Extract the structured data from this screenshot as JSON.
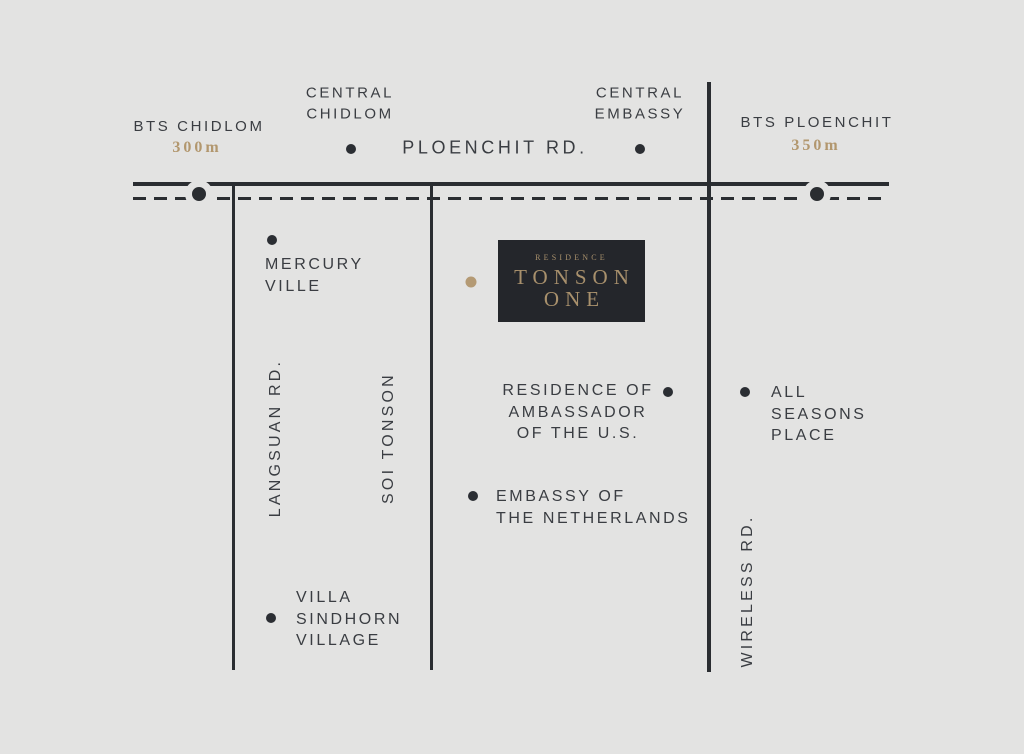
{
  "colors": {
    "background": "#e3e3e2",
    "ink": "#2a2d31",
    "text": "#3a3d42",
    "gold": "#b2976e",
    "logo_background": "#24262b",
    "logo_gold": "#a8906c"
  },
  "top": {
    "central_chidlom": "CENTRAL\nCHIDLOM",
    "central_embassy": "CENTRAL\nEMBASSY",
    "bts_chidlom": "BTS CHIDLOM",
    "bts_chidlom_distance": "300m",
    "bts_ploenchit": "BTS PLOENCHIT",
    "bts_ploenchit_distance": "350m",
    "ploenchit_road": "PLOENCHIT RD."
  },
  "roads": {
    "langsuan": "LANGSUAN RD.",
    "soi_tonson": "SOI TONSON",
    "wireless": "WIRELESS RD."
  },
  "landmarks": {
    "mercury_ville": "MERCURY\nVILLE",
    "us_ambassador_residence": "RESIDENCE OF\nAMBASSADOR\nOF THE U.S.",
    "all_seasons_place": "ALL\nSEASONS\nPLACE",
    "netherlands_embassy": "EMBASSY OF\nTHE NETHERLANDS",
    "villa_sindhorn": "VILLA\nSINDHORN\nVILLAGE"
  },
  "logo": {
    "brand_small": "RESIDENCE",
    "name_line1": "TONSON",
    "name_line2": "ONE"
  }
}
